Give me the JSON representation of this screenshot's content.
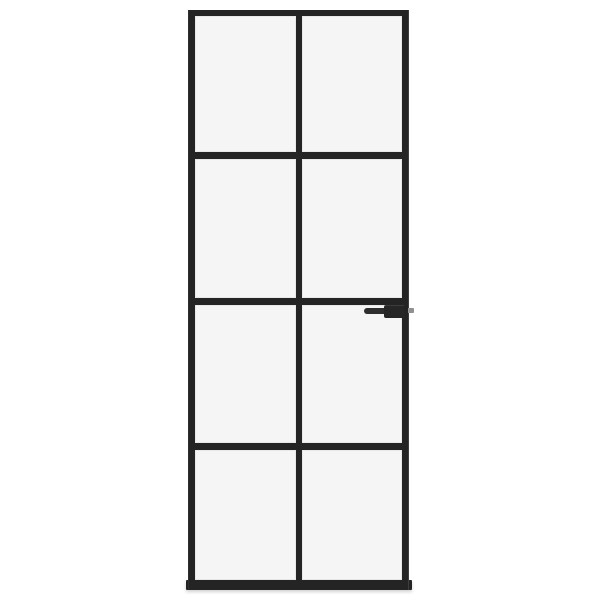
{
  "scene": {
    "description": "Product photo of a black slim-frame interior glass door with frosted-clear panes on a white background",
    "background_color": "#ffffff"
  },
  "door": {
    "frame_color": "#242424",
    "glass_color": "#f5f5f5",
    "grid": {
      "columns": 2,
      "rows": 4,
      "pane_count": 8
    },
    "handle": {
      "side": "right",
      "body_color": "#262626",
      "lever_color": "#2e2e2e",
      "latch_color": "#909090"
    }
  }
}
